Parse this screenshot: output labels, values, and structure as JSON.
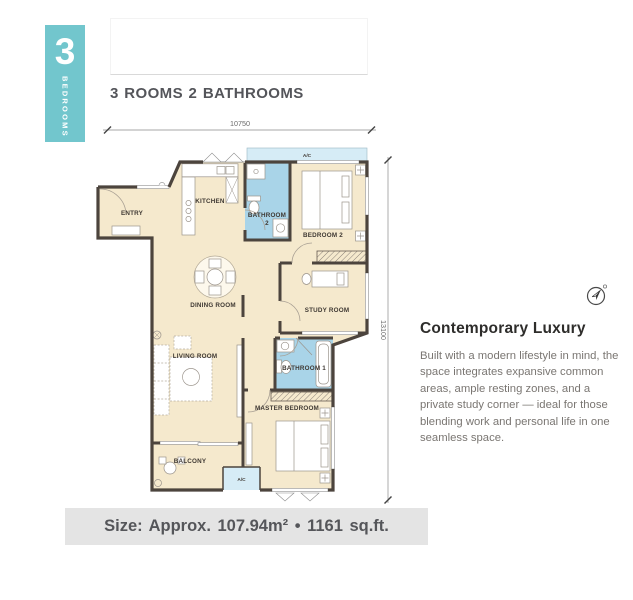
{
  "badge": {
    "number": "3",
    "label": "BEDROOMS",
    "color": "#72c6cd"
  },
  "title": "3 ROOMS 2 BATHROOMS",
  "floor_plan": {
    "dim_width": "10750",
    "dim_height": "13100",
    "rooms": {
      "entry": "ENTRY",
      "kitchen": "KITCHEN",
      "bathroom2_line1": "BATHROOM",
      "bathroom2_line2": "2",
      "bedroom2": "BEDROOM 2",
      "dining": "DINING ROOM",
      "study": "STUDY ROOM",
      "living": "LIVING ROOM",
      "bathroom1": "BATHROOM 1",
      "master_bedroom": "MASTER BEDROOM",
      "balcony": "BALCONY"
    },
    "ac_top": "A/C",
    "ac_bottom": "A/C",
    "colors": {
      "floor": "#f5e9cd",
      "bathroom_floor": "#a9d4e8",
      "ac_ledge": "#d6ecf6",
      "wall": "#4c443d"
    }
  },
  "description": {
    "heading": "Contemporary Luxury",
    "body": "Built with a modern lifestyle in mind, the space integrates expansive common areas, ample resting zones, and a private study corner — ideal for those blending work and personal life in one seamless space."
  },
  "size_bar": "Size: Approx. 107.94m²  •  1161 sq.ft."
}
